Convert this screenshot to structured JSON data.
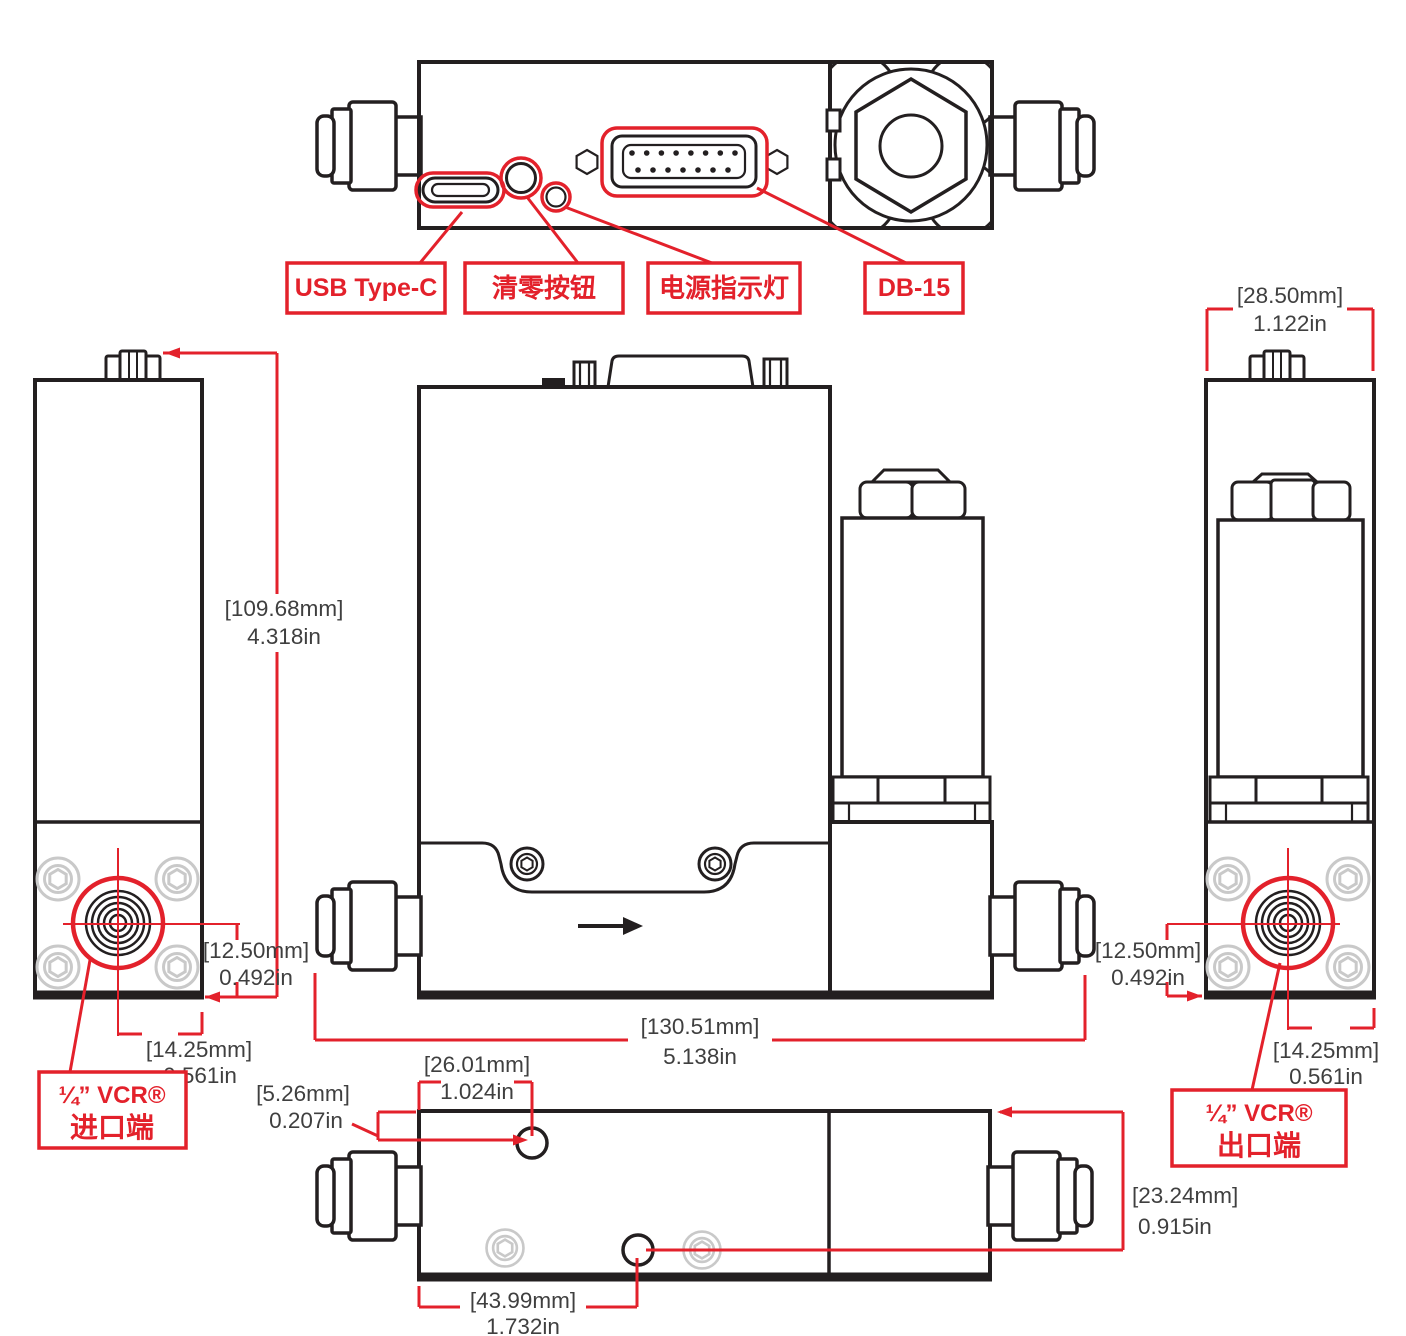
{
  "colors": {
    "red": "#E3212B",
    "line": "#231F20",
    "gray": "#C9C9C9",
    "ink": "#3F3F3F",
    "bg": "#FFFFFF"
  },
  "top_view": {
    "callouts": {
      "usb": "USB Type-C",
      "zero_button": "清零按钮",
      "power_led": "电源指示灯",
      "db15": "DB-15"
    }
  },
  "ports": {
    "inlet": {
      "title": "¼” VCR®",
      "subtitle": "进口端"
    },
    "outlet": {
      "title": "¼” VCR®",
      "subtitle": "出口端"
    }
  },
  "dimensions": {
    "overall_height": {
      "mm": "[109.68mm]",
      "in": "4.318in"
    },
    "overall_width": {
      "mm": "[130.51mm]",
      "in": "5.138in"
    },
    "body_depth": {
      "mm": "[28.50mm]",
      "in": "1.122in"
    },
    "inlet_port_height": {
      "mm": "[12.50mm]",
      "in": "0.492in"
    },
    "inlet_port_offset": {
      "mm": "[14.25mm]",
      "in": "0.561in"
    },
    "outlet_port_height": {
      "mm": "[12.50mm]",
      "in": "0.492in"
    },
    "outlet_port_offset": {
      "mm": "[14.25mm]",
      "in": "0.561in"
    },
    "mount_hole1_x": {
      "mm": "[26.01mm]",
      "in": "1.024in"
    },
    "mount_hole1_y": {
      "mm": "[5.26mm]",
      "in": "0.207in"
    },
    "mount_hole2_x": {
      "mm": "[43.99mm]",
      "in": "1.732in"
    },
    "mount_hole2_y": {
      "mm": "[23.24mm]",
      "in": "0.915in"
    }
  }
}
